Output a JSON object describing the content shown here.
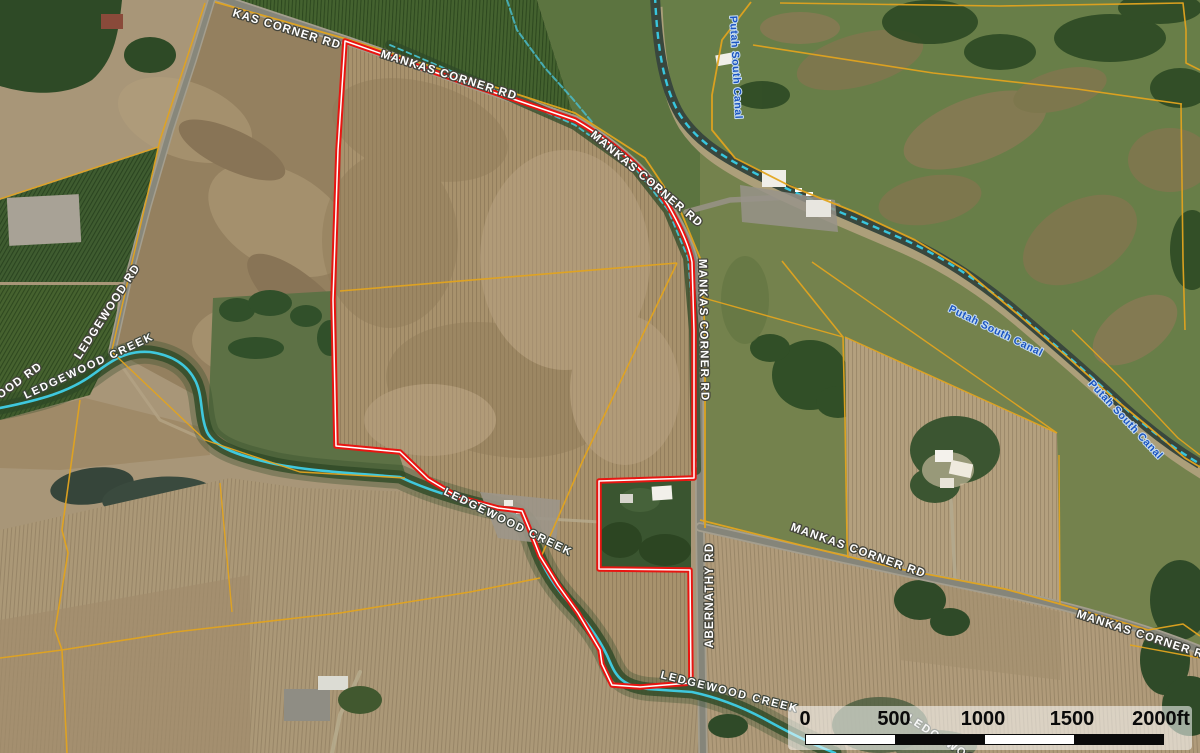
{
  "map": {
    "kind": "aerial-parcel-map",
    "subject": "Rural property with red parcel boundary along Mankas Corner Rd"
  },
  "labels": {
    "roads": [
      {
        "text": "KAS CORNER RD"
      },
      {
        "text": "MANKAS CORNER RD"
      },
      {
        "text": "MANKAS CORNER RD"
      },
      {
        "text": "MANKAS CORNER RD"
      },
      {
        "text": "MANKAS CORNER RD"
      },
      {
        "text": "MANKAS CORNER RD"
      },
      {
        "text": "ABERNATHY RD"
      },
      {
        "text": "LEDGEWOOD RD"
      },
      {
        "text": "OOD RD"
      }
    ],
    "water": [
      {
        "text": "LEDGEWOOD CREEK"
      },
      {
        "text": "LEDGEWOOD CREEK"
      },
      {
        "text": "LEDGEWOOD CREEK"
      },
      {
        "text": "LEDGEWOOD"
      },
      {
        "text": "Putah South Canal"
      },
      {
        "text": "Putah South Canal"
      },
      {
        "text": "Putah South Canal"
      }
    ]
  },
  "scale_bar": {
    "ticks": [
      "0",
      "500",
      "1000",
      "1500",
      "2000ft"
    ]
  },
  "colors": {
    "parcel_boundary": "#e81511",
    "parcel_boundary_center": "#ffffff",
    "parcel_lines": "#e2a41f",
    "creek": "#3fc8dd",
    "canal_dash": "#38c6de",
    "road_label_fill": "#ffffff",
    "canal_label_fill": "#1b55c0"
  }
}
